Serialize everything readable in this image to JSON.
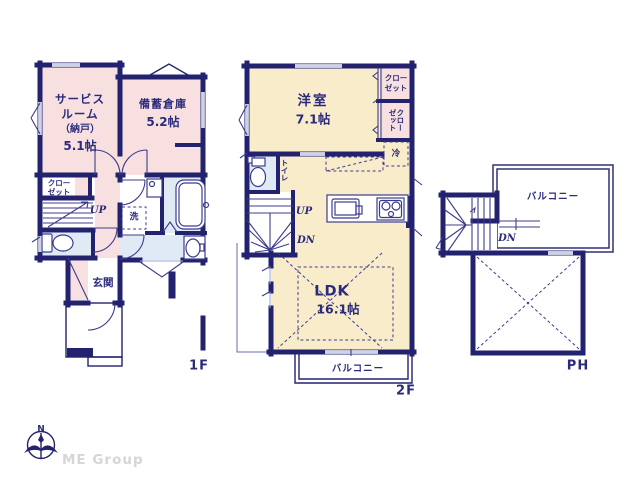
{
  "f1": {
    "floor_label": "1F",
    "service_room_l1": "サービス",
    "service_room_l2": "ルーム",
    "service_room_l3": "（納戸）",
    "service_room_l4": "5.1帖",
    "storage_l1": "備蓄倉庫",
    "storage_l2": "5.2帖",
    "closet_l1": "クロー",
    "closet_l2": "ゼット",
    "up": "UP",
    "washer": "洗",
    "entrance": "玄関"
  },
  "f2": {
    "floor_label": "2F",
    "western_room_l1": "洋室",
    "western_room_l2": "7.1帖",
    "closet1_l1": "クロー",
    "closet1_l2": "ゼット",
    "closet2_col1": "クロー",
    "closet2_col2": "ゼット",
    "toilet": "トイレ",
    "fridge": "冷",
    "up": "UP",
    "dn": "DN",
    "ldk_l1": "LDK",
    "ldk_l2": "16.1帖",
    "balcony": "バルコニー"
  },
  "ph": {
    "floor_label": "PH",
    "balcony": "バルコニー",
    "dn": "DN"
  },
  "logo": {
    "north": "N",
    "company": "ME Group"
  },
  "colors": {
    "wall": "#23226f",
    "room_pink": "#f8e0e0",
    "room_cream": "#f8ecca",
    "room_blue": "#dfeaf5",
    "text": "#2b2b7d",
    "logo_gray": "#d6d6d6",
    "window_line": "#9aa4d8",
    "fixture_line": "#3c3c8e"
  }
}
